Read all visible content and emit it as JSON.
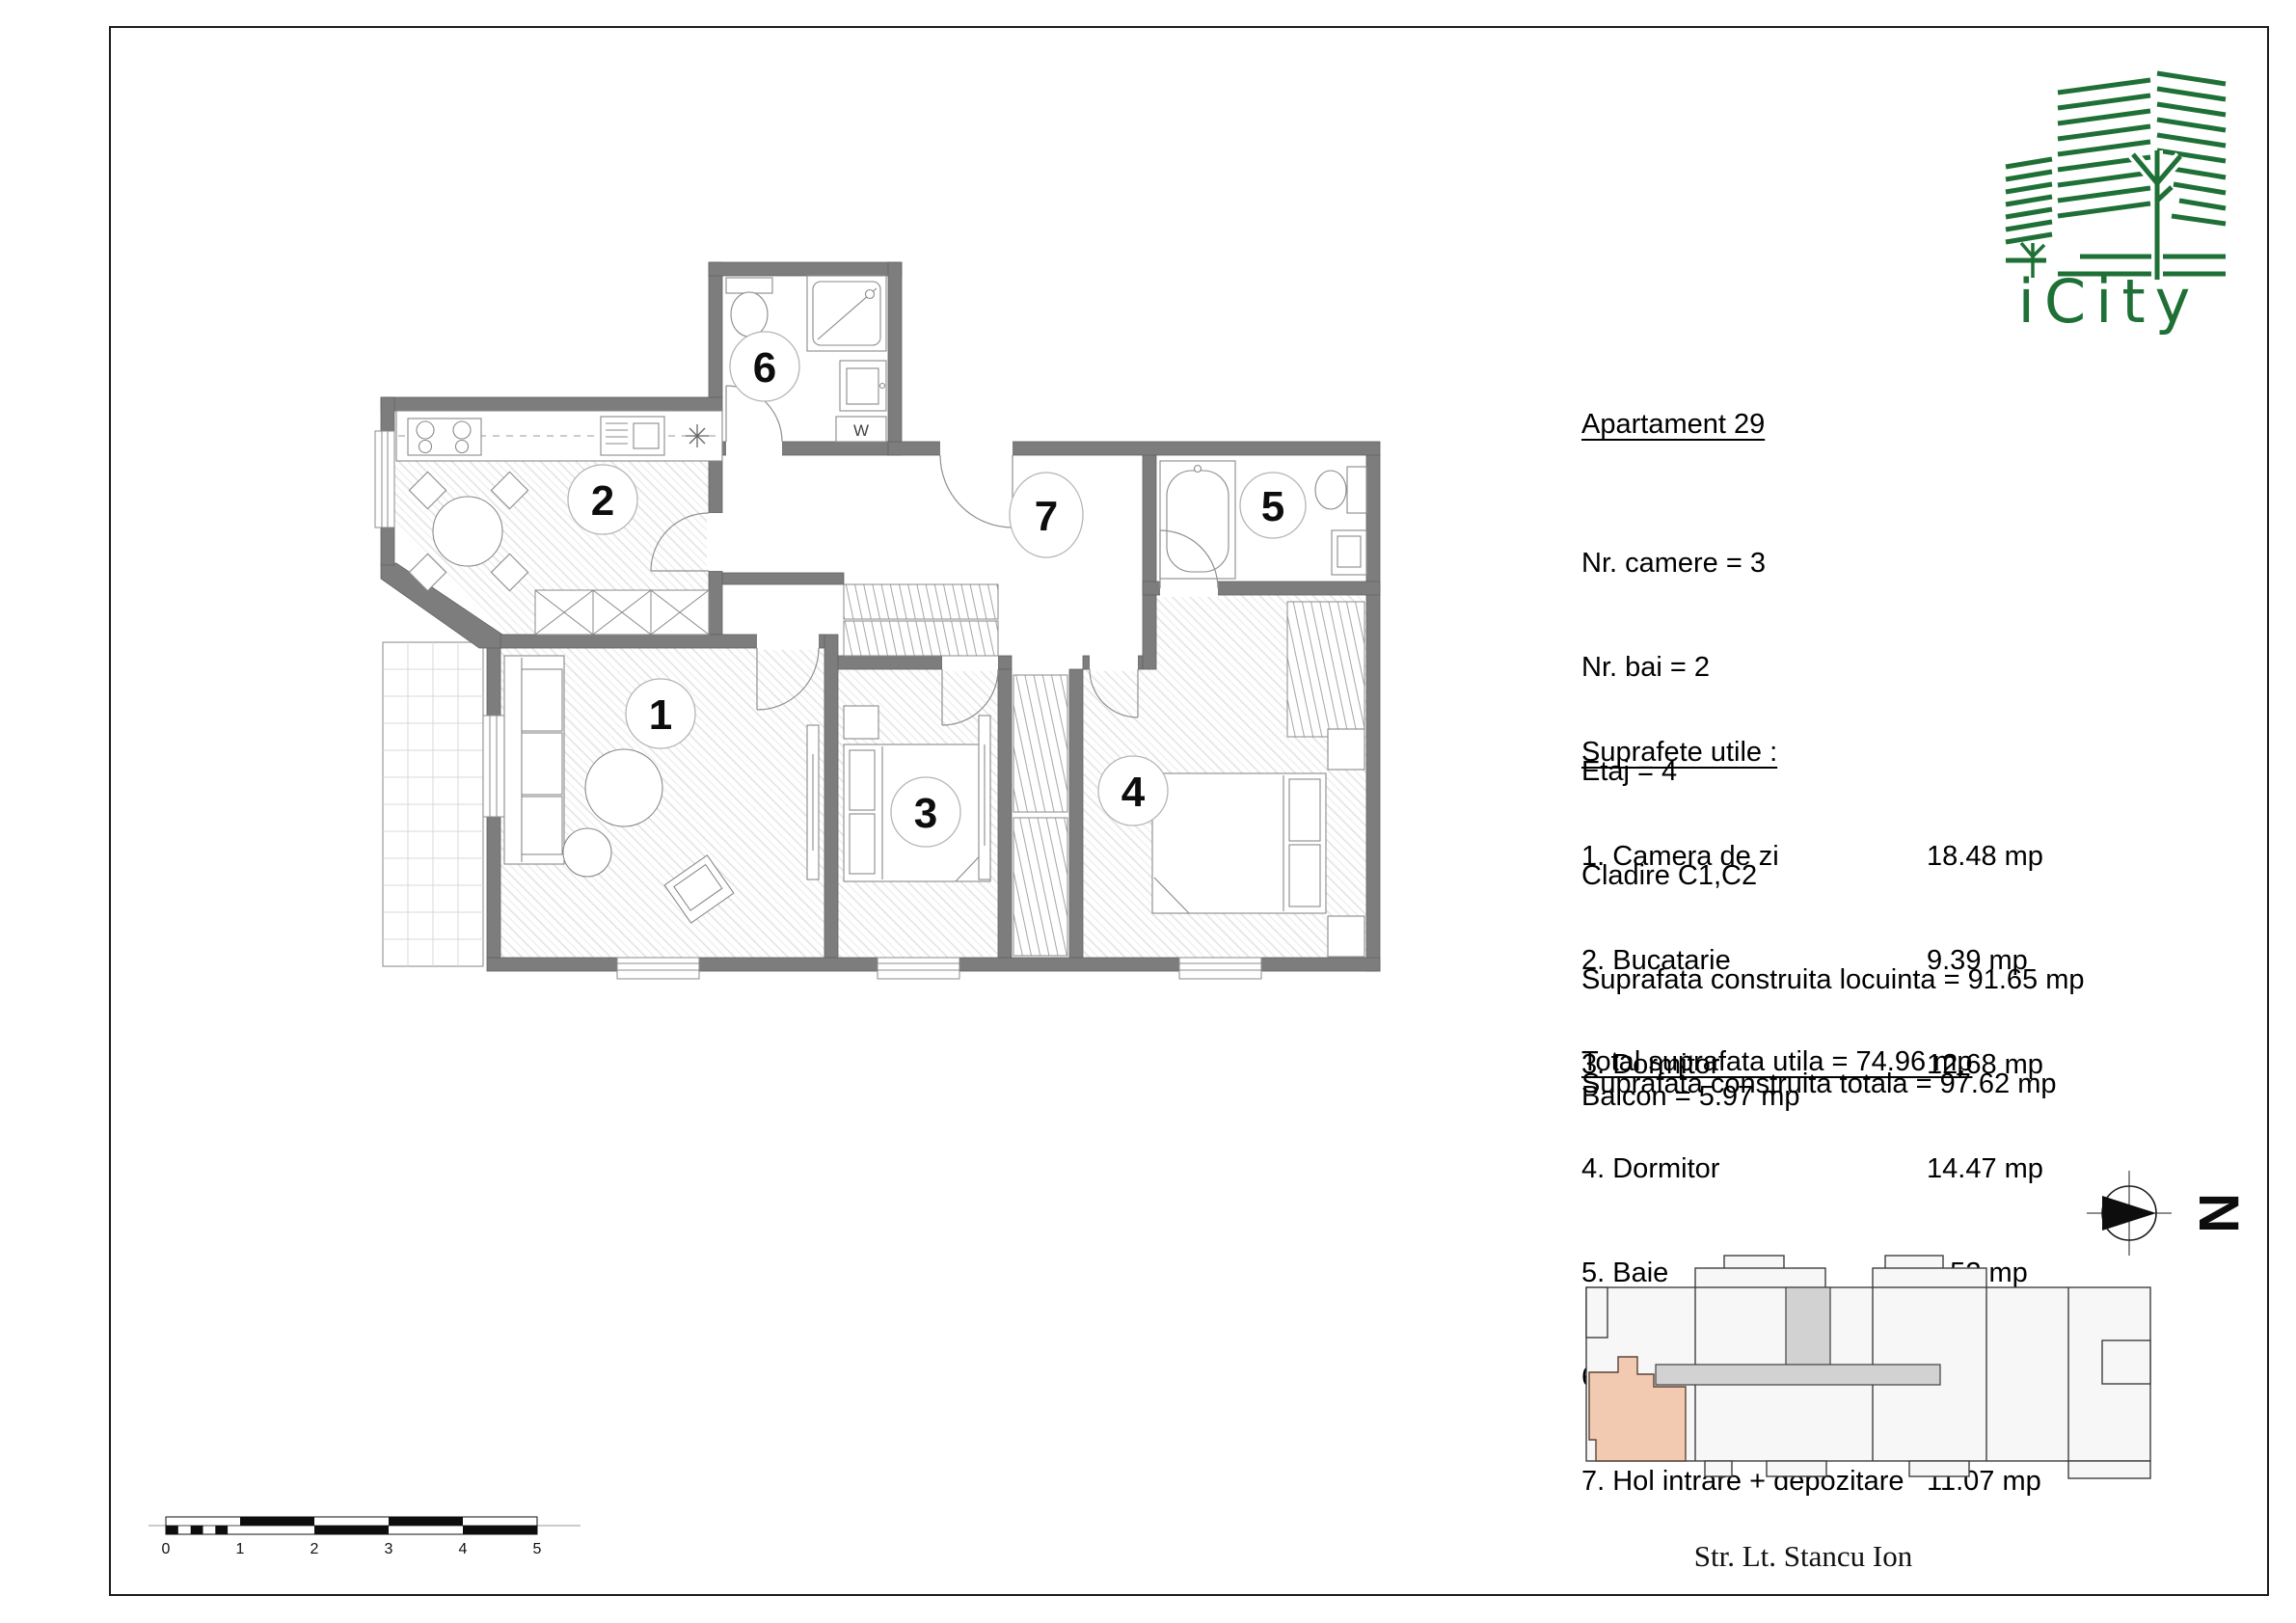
{
  "apartment": {
    "title": "Apartament 29",
    "details": [
      "Nr. camere = 3",
      "Nr. bai = 2",
      "Etaj = 4",
      "Cladire C1,C2",
      "Suprafata construita locuinta = 91.65 mp",
      "Suprafata construita totala = 97.62 mp"
    ]
  },
  "areas": {
    "heading": "Suprafete utile :",
    "rows": [
      {
        "name": "1. Camera de zi",
        "value": "18.48 mp"
      },
      {
        "name": "2. Bucatarie",
        "value": "9.39 mp"
      },
      {
        "name": "3. Dormitor",
        "value": "12.68 mp"
      },
      {
        "name": "4. Dormitor",
        "value": "14.47 mp"
      },
      {
        "name": "5. Baie",
        "value": "4.52 mp"
      },
      {
        "name": "6. Baie",
        "value": "4.35 mp"
      },
      {
        "name": "7. Hol intrare + depozitare",
        "value": "11.07 mp"
      }
    ],
    "total": "Total suprafata utila = 74.96 mp",
    "balcony": "Balcon = 5.97 mp"
  },
  "plan": {
    "room_numbers": [
      "1",
      "2",
      "3",
      "4",
      "5",
      "6",
      "7"
    ],
    "washer_label": "W",
    "wall_color": "#7d7d7d"
  },
  "logo": {
    "brand": "iCity",
    "color": "#1f7036"
  },
  "compass": {
    "north_label": "N"
  },
  "scale_bar": {
    "labels": [
      "0",
      "1",
      "2",
      "3",
      "4",
      "5"
    ]
  },
  "key_map": {
    "street_name": "Str. Lt. Stancu Ion",
    "highlight_color": "#f2c9b1",
    "building_color": "#f7f7f7",
    "corridor_color": "#d2d2d2"
  }
}
